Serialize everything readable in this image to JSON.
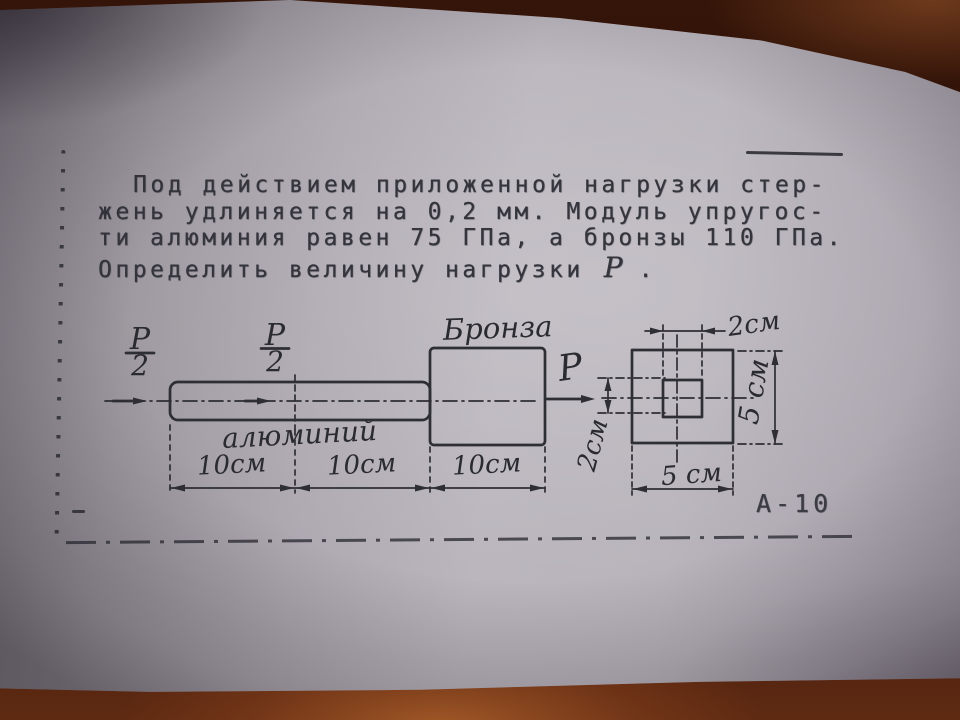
{
  "page": {
    "problem_text": {
      "line1": "Под действием приложенной нагрузки стер-",
      "line2": "жень удлиняется на 0,2 мм. Модуль упругос-",
      "line3": "ти алюминия равен 75 ГПа, а бронзы 110 ГПа.",
      "line4_prefix": "Определить величину нагрузки",
      "load_symbol": "P",
      "line4_suffix": "."
    },
    "sheet_code": "А-10"
  },
  "diagram": {
    "material_top_label": "Бронза",
    "material_bottom_label": "алюминий",
    "force_label": "P",
    "half_force": {
      "numerator": "P",
      "denominator": "2"
    },
    "dims": {
      "seg1": "10см",
      "seg2": "10см",
      "seg3": "10см",
      "inner_width": "2см",
      "inner_height": "2см",
      "outer_width": "5 см",
      "outer_height": "5 см"
    }
  },
  "colors": {
    "paper": "#b2adb5",
    "ink": "#2e2e35",
    "table": "#4a2012"
  }
}
